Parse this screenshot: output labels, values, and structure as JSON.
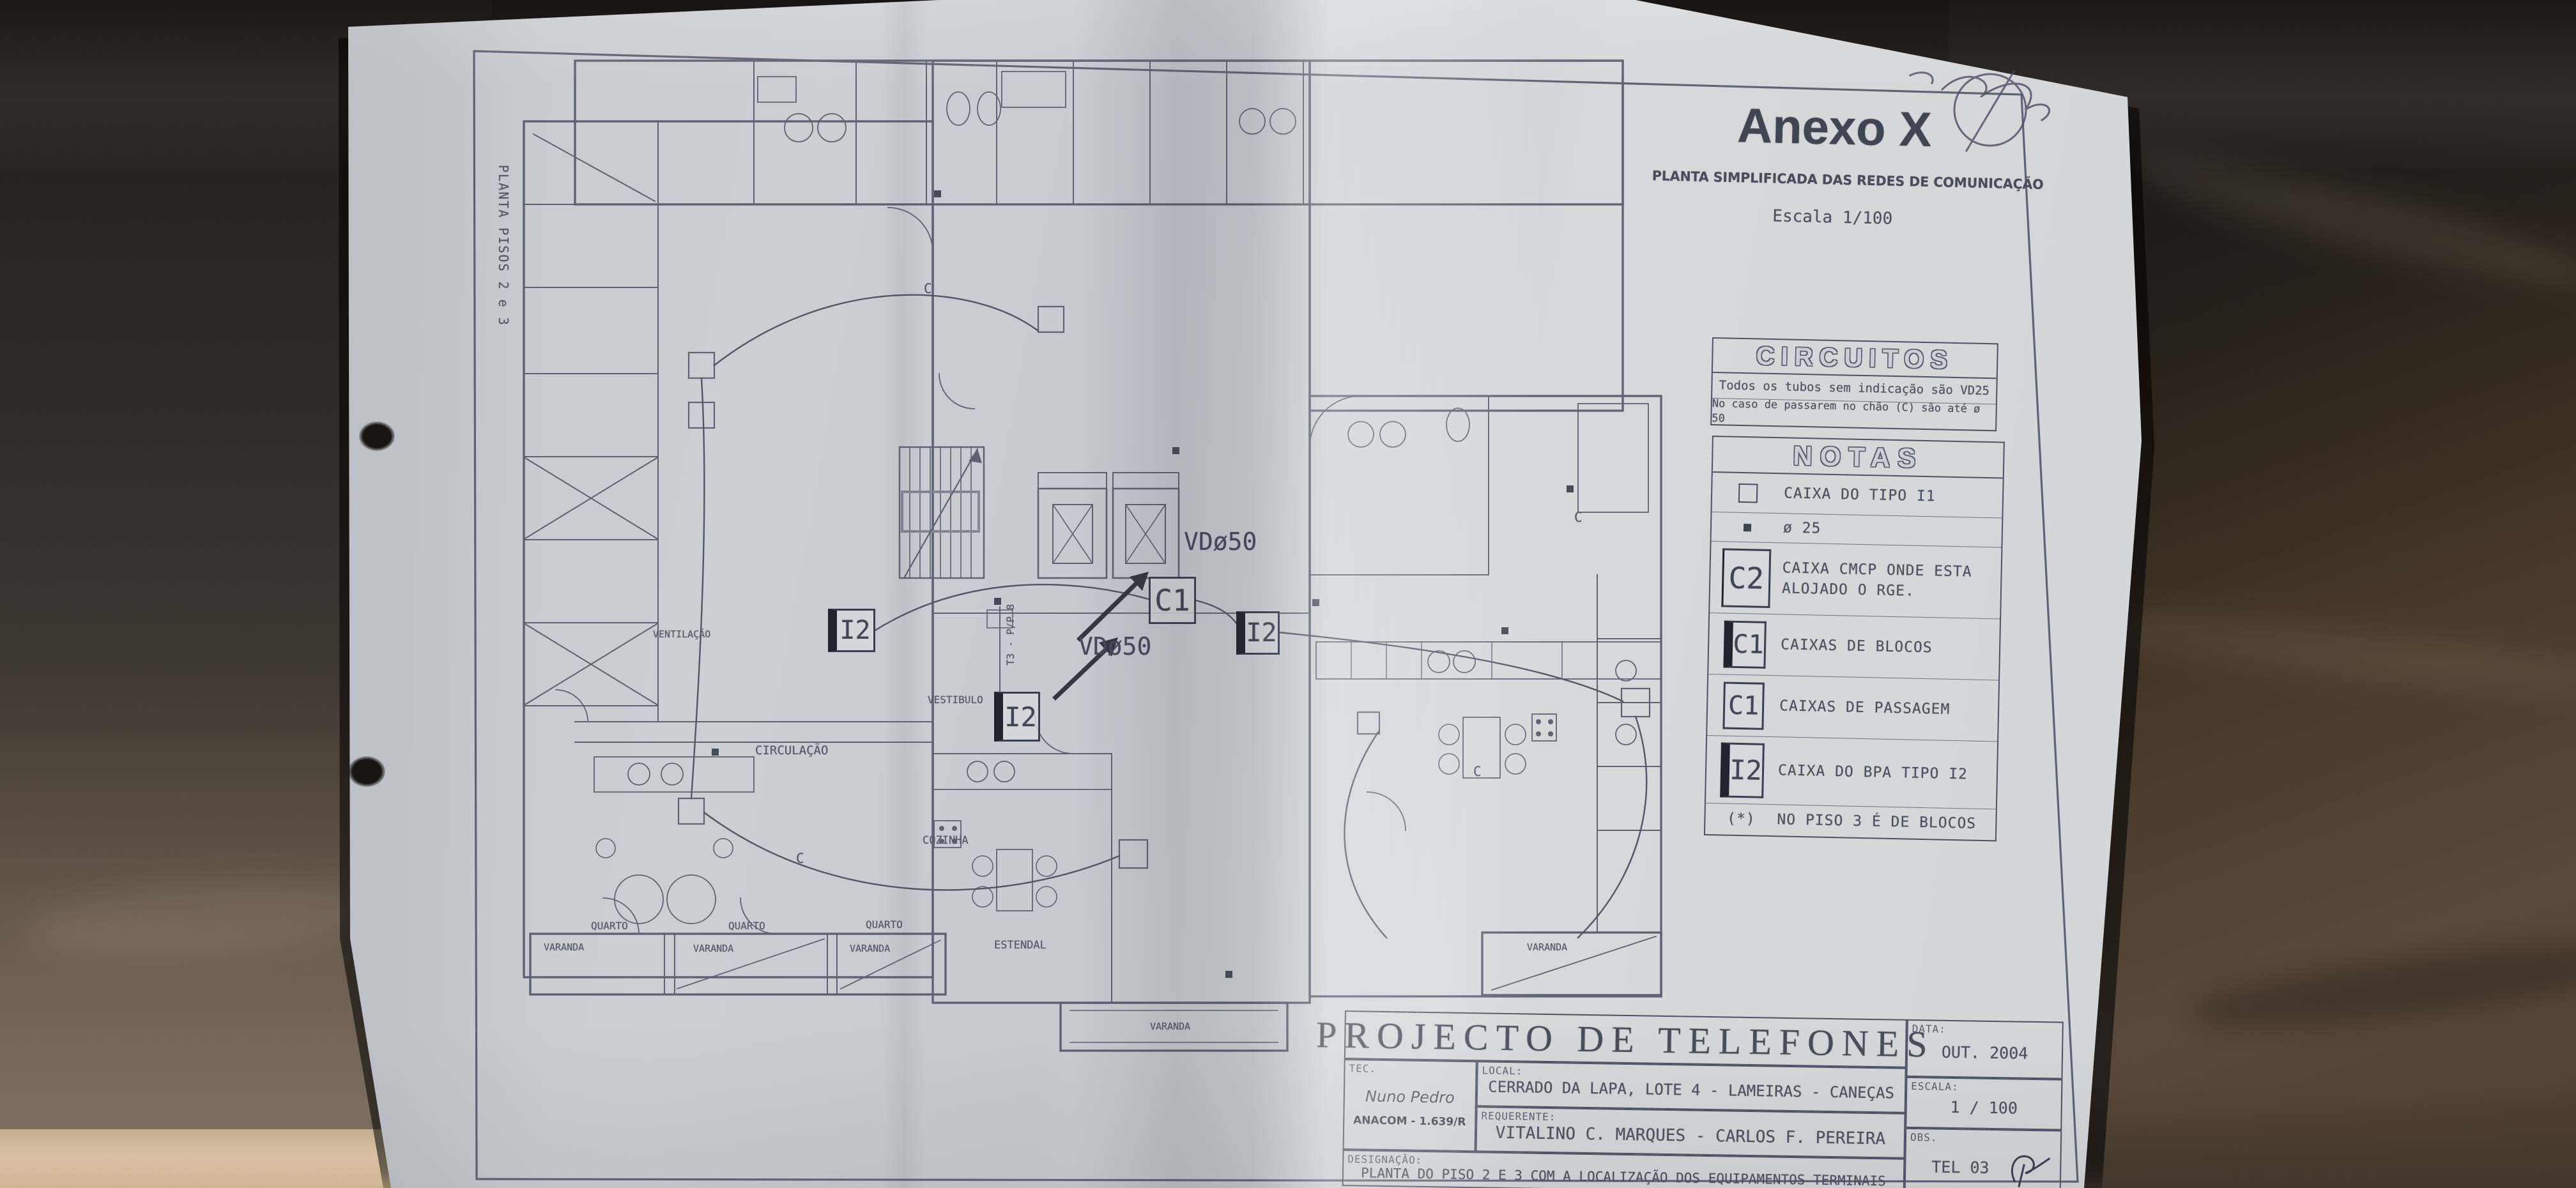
{
  "sheet": {
    "side_label": "PLANTA PISOS 2 e 3",
    "annex": {
      "title": "Anexo X",
      "subtitle": "PLANTA SIMPLIFICADA DAS REDES DE COMUNICAÇÃO",
      "scale_note": "Escala 1/100"
    },
    "circuits_box": {
      "header": "CIRCUITOS",
      "line1": "Todos os tubos sem indicação são VD25",
      "line2": "No caso de passarem no chão (C) são até ø 50"
    },
    "notes_box": {
      "header": "NOTAS",
      "rows": [
        {
          "symbol": "",
          "label": "CAIXA DO TIPO I1"
        },
        {
          "symbol": "",
          "label": "ø 25"
        },
        {
          "symbol": "C2",
          "label": "CAIXA CMCP ONDE ESTA ALOJADO O RGE."
        },
        {
          "symbol": "C1",
          "label": "CAIXAS DE BLOCOS"
        },
        {
          "symbol": "C1",
          "label": "CAIXAS DE PASSAGEM"
        },
        {
          "symbol": "I2",
          "label": "CAIXA DO BPA TIPO I2"
        },
        {
          "symbol": "(*)",
          "label": "NO PISO 3 É DE BLOCOS"
        }
      ]
    },
    "title_block": {
      "title": "PROJECTO DE TELEFONES",
      "tec_label": "TEC.",
      "tec_name": "Nuno Pedro",
      "tec_reg": "ANACOM - 1.639/R",
      "local_label": "LOCAL:",
      "local_value": "CERRADO DA LAPA, LOTE 4 - LAMEIRAS - CANEÇAS",
      "req_label": "REQUERENTE:",
      "req_value": "VITALINO C. MARQUES - CARLOS F. PEREIRA",
      "desig_label": "DESIGNAÇÃO:",
      "desig_value": "PLANTA DO PISO 2 E 3 COM A LOCALIZAÇÃO DOS EQUIPAMENTOS TERMINAIS",
      "data_label": "DATA:",
      "data_value": "OUT. 2004",
      "escala_label": "ESCALA:",
      "escala_value": "1 / 100",
      "obs_label": "OBS.",
      "obs_value": "TEL 03"
    },
    "plan": {
      "markers": {
        "c1": "C1",
        "i2": "I2",
        "vd50": "VDø50",
        "cable_letter": "C",
        "riser": "T3 - P/P 8"
      },
      "rooms": {
        "circulacao": "CIRCULAÇÃO",
        "vestibulo": "VESTIBULO",
        "ventilacao": "VENTILAÇÃO",
        "cozinha": "COZINHA",
        "estendal": "ESTENDAL",
        "quarto": "QUARTO",
        "varanda": "VARANDA"
      }
    }
  },
  "colors": {
    "paper": "#ced1d6",
    "ink": "#4a5162",
    "ink_dark": "#2e3442",
    "leather_dark": "#241f1c",
    "leather_brown": "#4c3e31",
    "leather_tan": "#d8c2a4"
  }
}
